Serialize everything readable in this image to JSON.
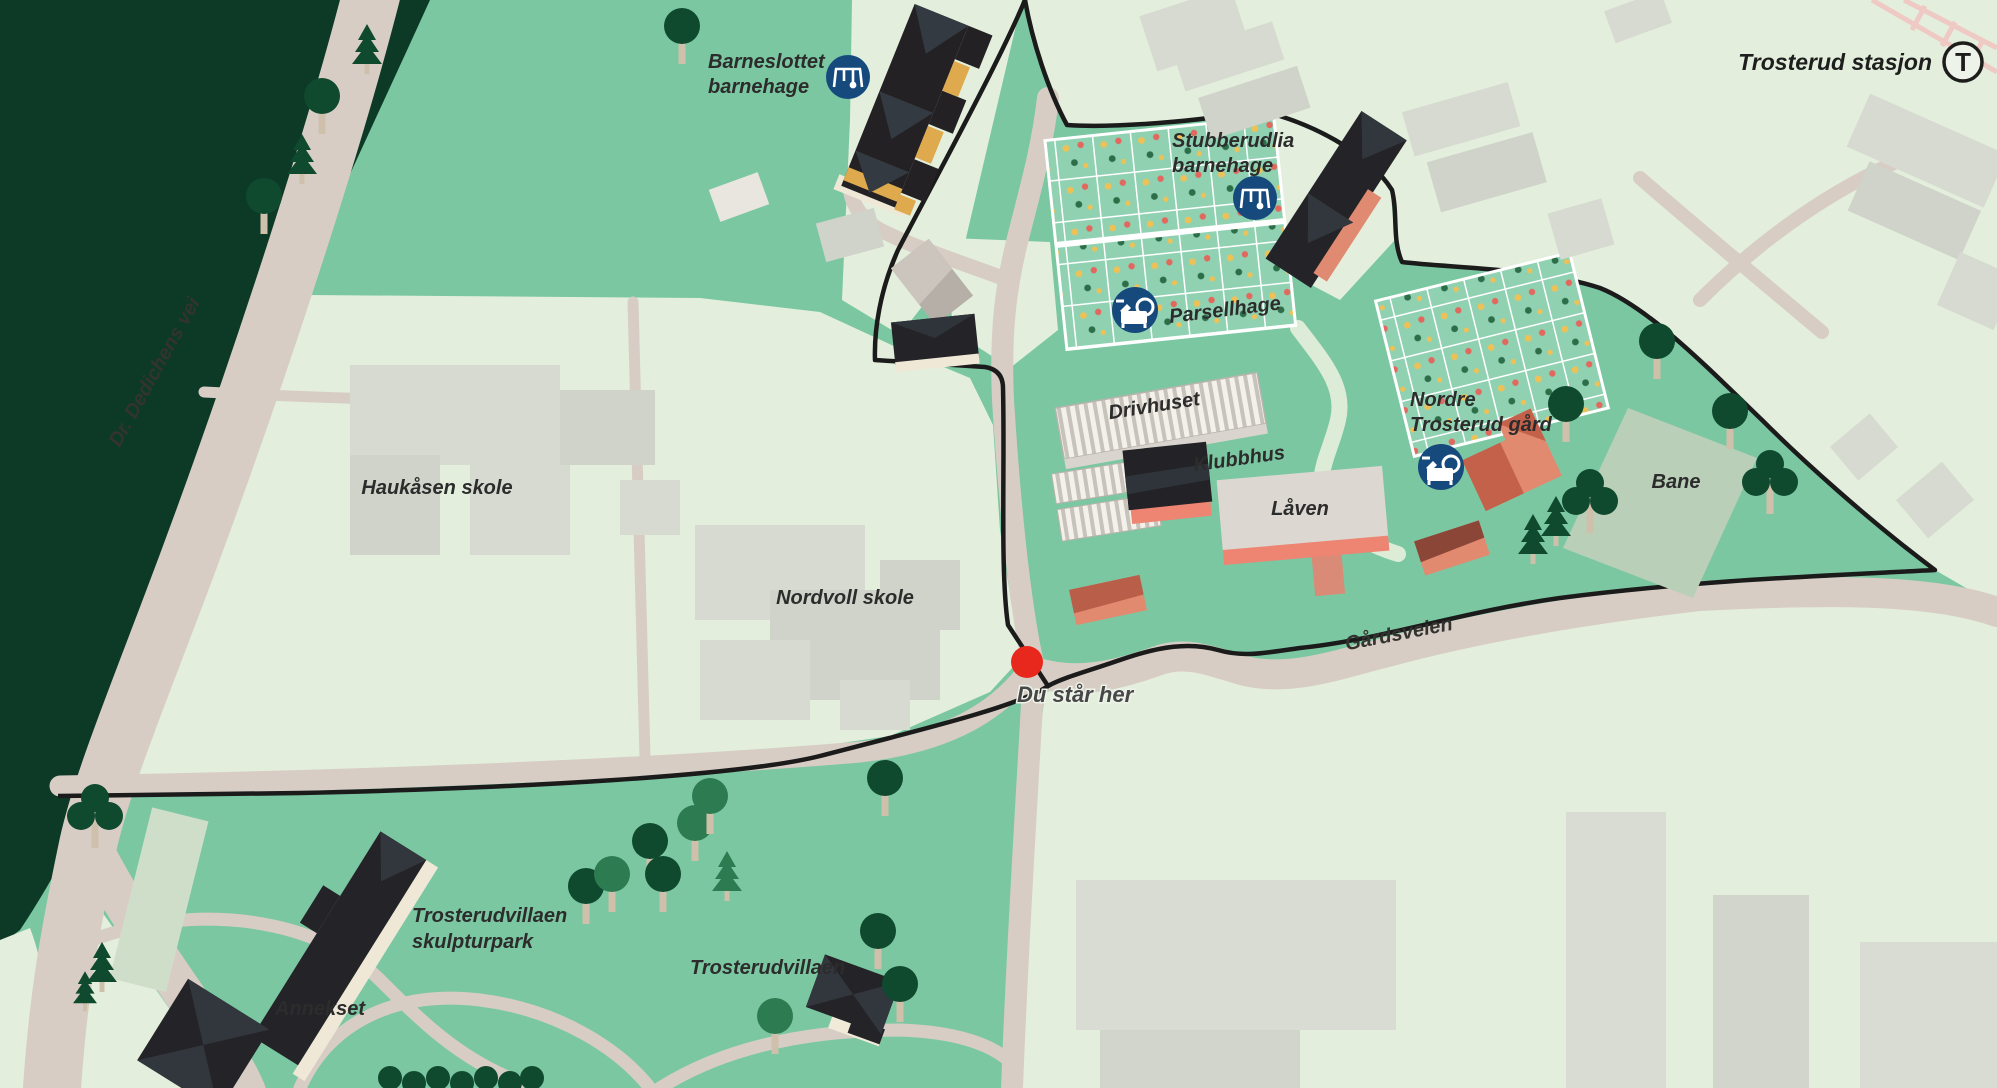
{
  "map": {
    "labels": {
      "barneslottet_1": "Barneslottet",
      "barneslottet_2": "barnehage",
      "trosterud_stasjon": "Trosterud stasjon",
      "stubberudlia_1": "Stubberudlia",
      "stubberudlia_2": "barnehage",
      "parsellhage": "Parsellhage",
      "drivhuset": "Drivhuset",
      "klubbhus": "Klubbhus",
      "laaven": "Låven",
      "nordre_1": "Nordre",
      "nordre_2": "Trosterud gård",
      "bane": "Bane",
      "gaardsveien": "Gårdsveien",
      "du_staar_her": "Du står her",
      "haukaasen_skole": "Haukåsen skole",
      "nordvoll_skole": "Nordvoll skole",
      "skulpturpark_1": "Trosterudvillaen",
      "skulpturpark_2": "skulpturpark",
      "trosterudvillaen": "Trosterudvillaen",
      "annekset": "Annekset",
      "dr_dedichens_vei": "Dr. Dedichens vei",
      "metro_t": "T"
    },
    "icons": {
      "playground": "playground-swing-icon (dark blue circle, white swing glyph)",
      "watering_can": "watering-can-icon (dark blue circle, white can glyph)",
      "metro": "metro-T-icon (white circle, black T)",
      "you_are_here": "red-dot-marker"
    },
    "colors": {
      "park_green": "#7bc7a2",
      "outside_green": "#e3efdc",
      "forest_green": "#0d3a26",
      "road_beige": "#d8cdc5",
      "boundary_black": "#1b1b1b",
      "building_dark": "#242327",
      "building_yellow": "#dfa94d",
      "building_gray": "#d7dad1",
      "building_salmon": "#e18a70",
      "laaven_base_salmon": "#ee8472",
      "icon_blue": "#164a7c",
      "marker_red": "#e8281c",
      "sports_field": "#b9cfb7",
      "tree_dark": "#0f4a2f",
      "tree_medium": "#2d7c51",
      "trunk": "#cfc0ab",
      "allotment_cell": "#90d1b2"
    }
  }
}
